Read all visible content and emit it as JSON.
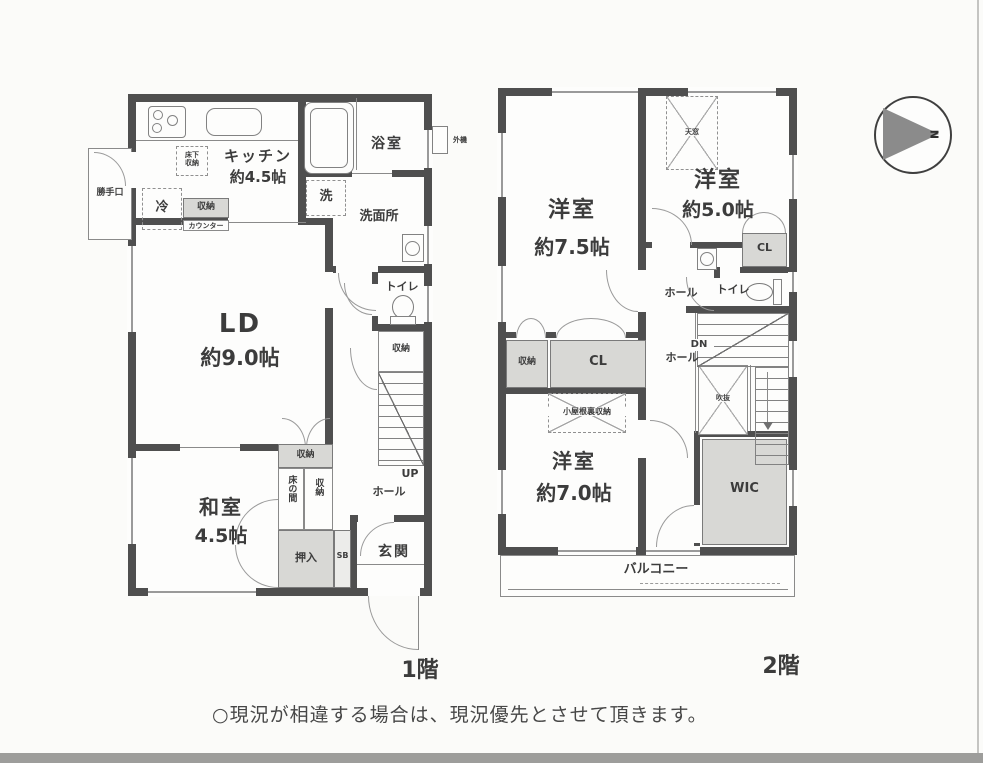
{
  "page": {
    "note": "○現況が相違する場合は、現況優先とさせて頂きます。"
  },
  "compass": {
    "north": "N"
  },
  "floor1": {
    "caption": "1階",
    "kitchen_name": "キッチン",
    "kitchen_size": "約4.5帖",
    "bath": "浴室",
    "laundry": "洗",
    "washroom": "洗面所",
    "backdoor": "勝手口",
    "fridge": "冷",
    "kitchen_storage": "収納",
    "counter": "カウンター",
    "underfloor_storage": "床下収納",
    "water_heater": "外機",
    "ld_name": "LD",
    "ld_size": "約9.0帖",
    "toilet": "トイレ",
    "stair_storage": "収納",
    "up": "UP",
    "hall": "ホール",
    "washitsu_name": "和室",
    "washitsu_size": "4.5帖",
    "storage_top": "収納",
    "tokonoma": "床の間",
    "storage_side": "収納",
    "oshiire": "押入",
    "shoebox": "SB",
    "genkan": "玄関"
  },
  "floor2": {
    "caption": "2階",
    "western75_name": "洋室",
    "western75_size": "約7.5帖",
    "western50_name": "洋室",
    "western50_size": "約5.0帖",
    "skylight": "天窓",
    "closet_small": "CL",
    "toilet": "トイレ",
    "hall_upper": "ホール",
    "hall_lower": "ホール",
    "dn": "DN",
    "storage": "収納",
    "closet": "CL",
    "void": "吹抜",
    "attic_storage": "小屋根裏収納",
    "western70_name": "洋室",
    "western70_size": "約7.0帖",
    "wic": "WIC",
    "balcony": "バルコニー"
  }
}
